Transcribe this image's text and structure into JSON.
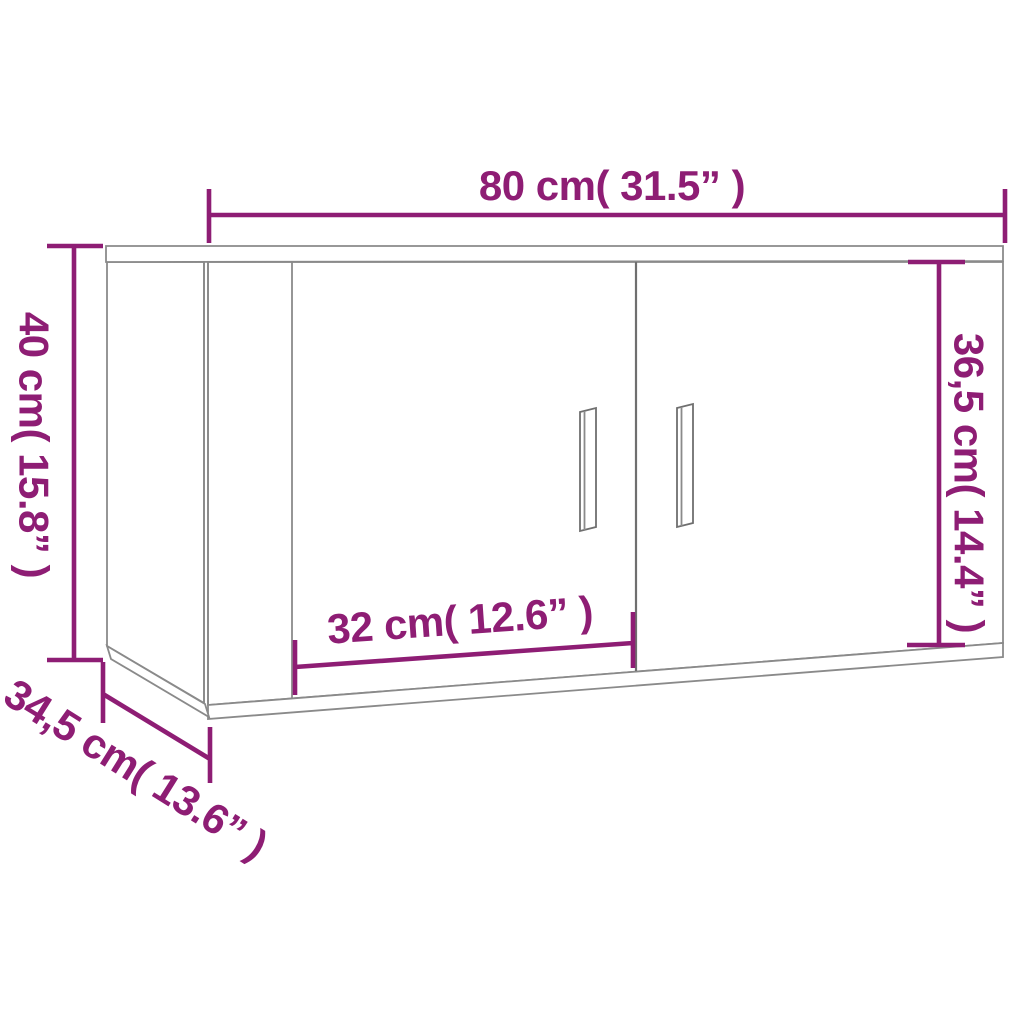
{
  "diagram": {
    "title": "Wall-mounted TV cabinet dimension diagram",
    "product": "Two-door wall cabinet line drawing with vertical bar handles",
    "colors": {
      "dimension_accent": "#8e1d74",
      "outline_gray": "#8a8a8a",
      "background": "#ffffff"
    },
    "dimensions": {
      "width": {
        "label": "80 cm( 31.5” )",
        "cm": "80",
        "inches": "31.5"
      },
      "height": {
        "label": "40 cm( 15.8” )",
        "cm": "40",
        "inches": "15.8"
      },
      "inner_height": {
        "label": "36,5 cm( 14.4” )",
        "cm": "36,5",
        "inches": "14.4"
      },
      "door_width": {
        "label": "32 cm( 12.6” )",
        "cm": "32",
        "inches": "12.6"
      },
      "depth": {
        "label": "34,5 cm( 13.6” )",
        "cm": "34,5",
        "inches": "13.6"
      }
    }
  }
}
